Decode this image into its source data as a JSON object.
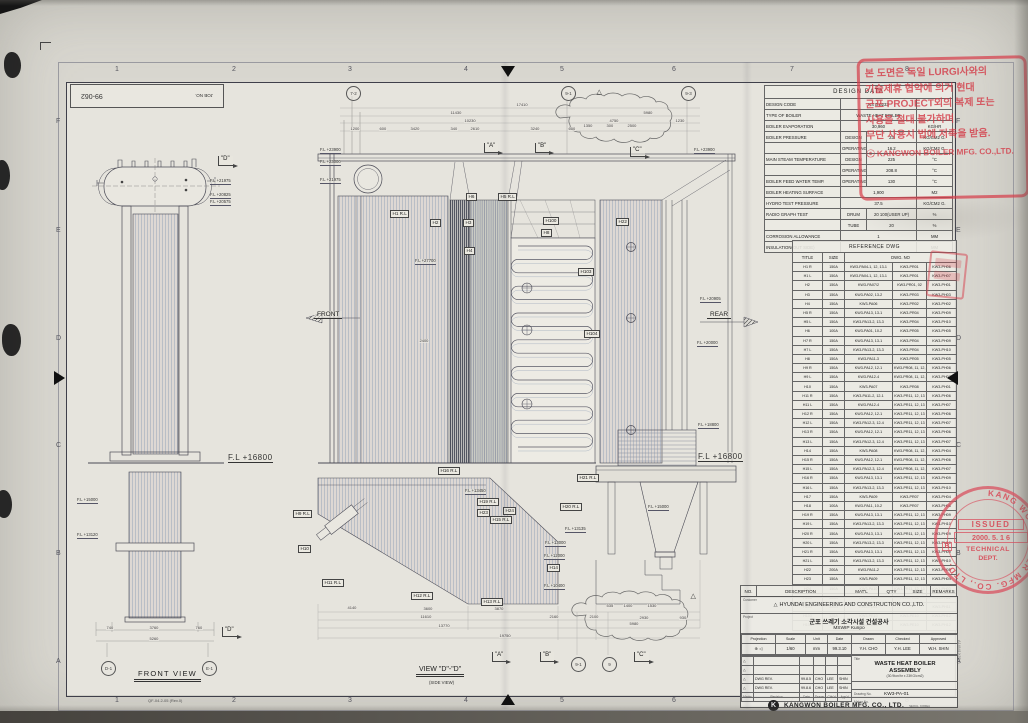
{
  "meta": {
    "job_no_label": "JOB NO.",
    "job_no": "99-062",
    "doc_code": "QF-04.2-05 (Rev.0)",
    "paper_size": "A1(841X594)"
  },
  "grid": {
    "numbers": [
      "1",
      "2",
      "3",
      "4",
      "5",
      "6",
      "7",
      "8"
    ],
    "letters": [
      "F",
      "E",
      "D",
      "C",
      "B",
      "A"
    ]
  },
  "views": {
    "front_view_title": "FRONT VIEW",
    "side_view_title": "VIEW \"D\"-\"D\"",
    "side_view_subtitle": "(SIDE VIEW)",
    "dir_labels": [
      [
        "FRONT",
        314,
        311
      ],
      [
        "REAR",
        707,
        311
      ]
    ],
    "markers": [
      [
        "\"A\"",
        484,
        143
      ],
      [
        "\"B\"",
        535,
        143
      ],
      [
        "\"C\"",
        630,
        147
      ],
      [
        "\"A\"",
        492,
        652
      ],
      [
        "\"B\"",
        540,
        652
      ],
      [
        "\"C\"",
        634,
        652
      ],
      [
        "\"D\"",
        218,
        156
      ],
      [
        "\"D\"",
        222,
        627
      ]
    ],
    "bubbles": [
      [
        "7-2",
        346,
        86
      ],
      [
        "9-1",
        561,
        86
      ],
      [
        "9-3",
        681,
        86
      ],
      [
        "9-1",
        571,
        657
      ],
      [
        "9",
        602,
        657
      ],
      [
        "D-1",
        101,
        661
      ],
      [
        "E-1",
        202,
        661
      ]
    ],
    "fl_labels": [
      [
        "F.L +16800",
        228,
        453,
        "big"
      ],
      [
        "F.L +16800",
        698,
        452,
        "big"
      ],
      [
        "F.L +23900",
        320,
        148
      ],
      [
        "F.L +23000",
        320,
        160
      ],
      [
        "F.L +21975",
        320,
        178
      ],
      [
        "F.L +23900",
        694,
        148
      ],
      [
        "F.L +20905",
        700,
        297
      ],
      [
        "F.L +20000",
        697,
        341
      ],
      [
        "F.L +18800",
        698,
        423
      ],
      [
        "F.L +15000",
        648,
        505
      ],
      [
        "F.L +27700",
        415,
        259
      ],
      [
        "F.L +13450",
        465,
        489
      ],
      [
        "F.L +13135",
        565,
        527
      ],
      [
        "F.L +13000",
        545,
        541
      ],
      [
        "F.L +12000",
        544,
        554
      ],
      [
        "F.L +10400",
        544,
        584
      ],
      [
        "F.L +21975",
        210,
        179
      ],
      [
        "F.L +20825",
        210,
        193
      ],
      [
        "F.L +20575",
        210,
        200
      ],
      [
        "F.L +15000",
        77,
        498
      ],
      [
        "F.L +13120",
        77,
        533
      ]
    ],
    "h_labels": [
      [
        "H1 R.L",
        390,
        210
      ],
      [
        "H2",
        430,
        219
      ],
      [
        "H3",
        463,
        219
      ],
      [
        "H6",
        466,
        193
      ],
      [
        "H5 R.L",
        498,
        193
      ],
      [
        "H4",
        464,
        247
      ],
      [
        "H100",
        543,
        217
      ],
      [
        "H8",
        541,
        229
      ],
      [
        "H22",
        616,
        218
      ],
      [
        "H103",
        578,
        268
      ],
      [
        "H104",
        584,
        330
      ],
      [
        "H9 R.L",
        293,
        510
      ],
      [
        "H10",
        298,
        545
      ],
      [
        "H11 R.L",
        322,
        579
      ],
      [
        "H12 R.L",
        411,
        592
      ],
      [
        "H13 R.L",
        481,
        598
      ],
      [
        "H14",
        547,
        564
      ],
      [
        "H15 R.L",
        490,
        516
      ],
      [
        "H16 R.L",
        438,
        467
      ],
      [
        "H19 R.L",
        477,
        498
      ],
      [
        "H23",
        477,
        509
      ],
      [
        "H24",
        503,
        507
      ],
      [
        "H20 R.L",
        560,
        503
      ],
      [
        "H21 R.L",
        577,
        474
      ]
    ],
    "dims": [
      [
        "17410",
        516,
        103
      ],
      [
        "11430",
        450,
        111
      ],
      [
        "5980",
        643,
        111
      ],
      [
        "10230",
        464,
        119
      ],
      [
        "4750",
        609,
        119
      ],
      [
        "1230",
        675,
        119
      ],
      [
        "1200",
        350,
        127
      ],
      [
        "600",
        379,
        127
      ],
      [
        "3420",
        410,
        127
      ],
      [
        "340",
        450,
        127
      ],
      [
        "2610",
        470,
        127
      ],
      [
        "3240",
        530,
        127
      ],
      [
        "600",
        568,
        127
      ],
      [
        "1350",
        583,
        124
      ],
      [
        "300",
        606,
        124
      ],
      [
        "2500",
        627,
        124
      ],
      [
        "4140",
        347,
        606
      ],
      [
        "3600",
        423,
        607
      ],
      [
        "3870",
        494,
        607
      ],
      [
        "535",
        606,
        604
      ],
      [
        "1400",
        623,
        604
      ],
      [
        "1530",
        647,
        604
      ],
      [
        "11610",
        420,
        615
      ],
      [
        "2160",
        549,
        615
      ],
      [
        "2100",
        589,
        615
      ],
      [
        "2930",
        639,
        616
      ],
      [
        "930",
        679,
        616
      ],
      [
        "13770",
        438,
        624
      ],
      [
        "5980",
        629,
        622
      ],
      [
        "19750",
        499,
        634
      ],
      [
        "740",
        106,
        626
      ],
      [
        "3760",
        149,
        626
      ],
      [
        "760",
        195,
        626
      ],
      [
        "5260",
        149,
        637
      ],
      [
        "2400",
        419,
        339
      ],
      [
        "△",
        596,
        91,
        "tri"
      ],
      [
        "△",
        690,
        595,
        "tri"
      ]
    ]
  },
  "design_data": {
    "title": "DESIGN DATA",
    "rows": [
      [
        "DESIGN CODE",
        "",
        "KS B 6233",
        ""
      ],
      [
        "TYPE OF BOILER",
        "",
        "WASTE HEAT BOILER",
        ""
      ],
      [
        "BOILER EVAPORATION",
        "",
        "30,960",
        "KG/HR"
      ],
      [
        "BOILER PRESSURE",
        "DESIGN",
        "23",
        "KG/CM2 G."
      ],
      [
        "",
        "OPERATING",
        "16.2",
        "KG/CM2 G."
      ],
      [
        "MAIN STEAM TEMPERATURE",
        "DESIGN",
        "225",
        "°C"
      ],
      [
        "",
        "OPERATING",
        "208.8",
        "°C"
      ],
      [
        "BOILER FEED WATER TEMP.",
        "OPERATING",
        "130",
        "°C"
      ],
      [
        "BOILER HEATING SURFACE",
        "",
        "1,900",
        "M2"
      ],
      [
        "HYDRO TEST PRESSURE",
        "",
        "37.5",
        "KG/CM2 G."
      ],
      [
        "RADIO GRAPH TEST",
        "DRUM",
        "20  100(USER UP)",
        "%"
      ],
      [
        "",
        "TUBE",
        "20",
        "%"
      ],
      [
        "CORROSION ALLOWANCE",
        "",
        "1",
        "MM"
      ],
      [
        "INSULATION(OUT SIDE)",
        "",
        "150",
        "MM"
      ]
    ]
  },
  "reference_dwg": {
    "title": "REFERENCE DWG",
    "col_title": "TITLE",
    "col_size": "SIZE",
    "col_dwg": "DWG. NO",
    "rows": [
      [
        "H1 R",
        "150A",
        "KW3-PA04-1, 12, 13-1",
        "KW3-PR01",
        "KW3-PH06"
      ],
      [
        "H1 L",
        "150A",
        "KW3-PA04-1, 12, 13-1",
        "KW3-PR01",
        "KW3-PH07"
      ],
      [
        "H2",
        "150A",
        "KW3-PA07/2",
        "KW3-PR01, 02",
        "KW3-PH01"
      ],
      [
        "H3",
        "150A",
        "KW3-PA02, 13-2",
        "KW3-PR03",
        "KW3-PH03"
      ],
      [
        "H4",
        "150A",
        "KW3-PA06",
        "KW3-PR02",
        "KW3-PH02"
      ],
      [
        "H5 R",
        "150A",
        "KW3-PA13, 13-1",
        "KW3-PR04",
        "KW3-PH09"
      ],
      [
        "H5 L",
        "150A",
        "KW3-PA13-2, 13-3",
        "KW3-PR04",
        "KW3-PH10"
      ],
      [
        "H6",
        "100A",
        "KW3-PA01, 10-2",
        "KW3-PR05",
        "KW3-PH05"
      ],
      [
        "H7 R",
        "150A",
        "KW3-PA13, 13-1",
        "KW3-PR04",
        "KW3-PH09"
      ],
      [
        "H7 L",
        "150A",
        "KW3-PA13-2, 13-3",
        "KW3-PR04",
        "KW3-PH10"
      ],
      [
        "H8",
        "150A",
        "KW3-PA11-3",
        "KW3-PR05",
        "KW3-PH05"
      ],
      [
        "H9 R",
        "150A",
        "KW3-PA12, 12-1",
        "KW3-PR08, 11, 12, 13",
        "KW3-PH06"
      ],
      [
        "H9 L",
        "150A",
        "KW3-PA12-4",
        "KW3-PR08, 11, 12, 13",
        "KW3-PH07"
      ],
      [
        "H10",
        "150A",
        "KW3-PA07",
        "KW3-PR08",
        "KW3-PH01"
      ],
      [
        "H11 R",
        "150A",
        "KW3-PA11-2, 12-1",
        "KW3-PR11, 12, 13",
        "KW3-PH06"
      ],
      [
        "H11 L",
        "150A",
        "KW3-PA12-4",
        "KW3-PR11, 12, 13",
        "KW3-PH07"
      ],
      [
        "H12 R",
        "150A",
        "KW3-PA12, 12-1",
        "KW3-PR11, 12, 13",
        "KW3-PH06"
      ],
      [
        "H12 L",
        "150A",
        "KW3-PA12-3, 12-4",
        "KW3-PR11, 12, 13",
        "KW3-PH07"
      ],
      [
        "H13 R",
        "150A",
        "KW3-PA12, 12-1",
        "KW3-PR11, 12, 13",
        "KW3-PH06"
      ],
      [
        "H13 L",
        "150A",
        "KW3-PA12-3, 12-4",
        "KW3-PR11, 12, 13",
        "KW3-PH07"
      ],
      [
        "H14",
        "150A",
        "KW3-PA08",
        "KW3-PR08, 11, 12, 13",
        "KW3-PH04"
      ],
      [
        "H15 R",
        "150A",
        "KW3-PA12, 12-1",
        "KW3-PR08, 11, 12, 13",
        "KW3-PH06"
      ],
      [
        "H15 L",
        "150A",
        "KW3-PA12-3, 12-4",
        "KW3-PR08, 11, 12, 13",
        "KW3-PH07"
      ],
      [
        "H16 R",
        "150A",
        "KW3-PA13, 13-1",
        "KW3-PR11, 12, 13",
        "KW3-PH09"
      ],
      [
        "H16 L",
        "150A",
        "KW3-PA13-2, 13-3",
        "KW3-PR11, 12, 13",
        "KW3-PH10"
      ],
      [
        "H17",
        "150A",
        "KW3-PA09",
        "KW3-PR07",
        "KW3-PH04"
      ],
      [
        "H18",
        "100A",
        "KW3-PA11, 10-2",
        "KW3-PR07",
        "KW3-PH08"
      ],
      [
        "H19 R",
        "150A",
        "KW3-PA13, 13-1",
        "KW3-PR11, 12, 13",
        "KW3-PH09"
      ],
      [
        "H19 L",
        "150A",
        "KW3-PA13-2, 13-3",
        "KW3-PR11, 12, 13",
        "KW3-PH10"
      ],
      [
        "H20 R",
        "150A",
        "KW3-PA13, 13-1",
        "KW3-PR11, 12, 13",
        "KW3-PH09"
      ],
      [
        "H20 L",
        "150A",
        "KW3-PA13-2, 13-3",
        "KW3-PR11, 12, 13",
        "KW3-PH10"
      ],
      [
        "H21 R",
        "150A",
        "KW3-PA13, 13-1",
        "KW3-PR11, 12, 13",
        "KW3-PH09"
      ],
      [
        "H21 L",
        "150A",
        "KW3-PA13-2, 13-3",
        "KW3-PR11, 12, 13",
        "KW3-PH10"
      ],
      [
        "H22",
        "200A",
        "KW3-PA11-2",
        "KW3-PR11, 12, 13",
        "KW3-PH05"
      ],
      [
        "H23",
        "150A",
        "KW3-PA09",
        "KW3-PR11, 12, 13",
        "KW3-PH04"
      ],
      [
        "H24",
        "150A",
        "KW3-PA10",
        "KW3-PR11, 12, 13",
        "KW3-PH03"
      ],
      [
        "H100",
        "300A",
        "KW3-PD01",
        "KW3-PR06",
        "KW3-PH11"
      ],
      [
        "H101",
        "300A",
        "KW3-PD01",
        "",
        "KW3-PH11"
      ],
      [
        "H103",
        "125A",
        "KW3-PE10",
        "KW3-PE10",
        "KW3-PH12"
      ],
      [
        "H104",
        "125A",
        "KW3-PE10",
        "KW3-PE10",
        "KW3-PH12"
      ]
    ]
  },
  "parts_header": [
    "NO.",
    "DESCRIPTION",
    "MAT'L",
    "Q'TY",
    "SIZE",
    "REMARKS"
  ],
  "title_block": {
    "customer_label": "Customer",
    "customer": "HYUNDAI ENGINEERING AND CONSTRUCTION CO.,LTD.",
    "project_label": "Project",
    "project_kr": "군포 쓰레기 소각시설 건설공사",
    "project_en": "MSWIP  Kunpo",
    "head_cols": [
      "Projection",
      "Scale",
      "Unit",
      "Date",
      "Drawn",
      "Checked",
      "Approved"
    ],
    "head_vals": [
      "⊕ ◁",
      "1/60",
      "mm",
      "99.3.10",
      "Y.H. CHO",
      "Y.H. LEE",
      "W.H. SHIN"
    ],
    "rev_rows": [
      [
        "△",
        "",
        "",
        "",
        "",
        ""
      ],
      [
        "△",
        "",
        "",
        "",
        "",
        ""
      ],
      [
        "△",
        "DWG REV.",
        "99.8.5",
        "CHO",
        "LEE",
        "SHIN"
      ],
      [
        "△",
        "DWG REV.",
        "99.8.6",
        "CHO",
        "LEE",
        "SHIN"
      ]
    ],
    "rev_foot": [
      "Marks",
      "Revision",
      "Date",
      "Drawn",
      "Chk'd",
      "App'd"
    ],
    "title_label": "Title",
    "title_line1": "WASTE HEAT BOILER",
    "title_line2": "ASSEMBLY",
    "title_sub": "(30.9ton/hr x 23KG/cm2)",
    "drawing_no_label": "Drawing No.",
    "drawing_no": "KW3-PA-01",
    "maker_no_label": "Maker No.",
    "logo_letter": "K",
    "company": "KANGWON BOILER MFG. CO., LTD.",
    "company_sub": "SEOUL, KOREA"
  },
  "stamps": {
    "notice_lines": [
      "본 도면은 독일 LURGI사와의",
      "기술제휴 협약에 의거 현대",
      "군포 PROJECT외의 복제 또는",
      "사용을 절대 불가하며",
      "무단 사용시 법에 저촉을 받음."
    ],
    "notice_footer": "ⓒ KANGWON BOILER MFG. CO.,LTD.",
    "issued": {
      "ring_text": "KANG WON BOILER MFG. CO., LTD.",
      "line1": "ISSUED",
      "date": "2000. 5. 1 6",
      "dept1": "TECHNICAL",
      "dept2": "DEPT.",
      "side_letter": "B"
    }
  }
}
